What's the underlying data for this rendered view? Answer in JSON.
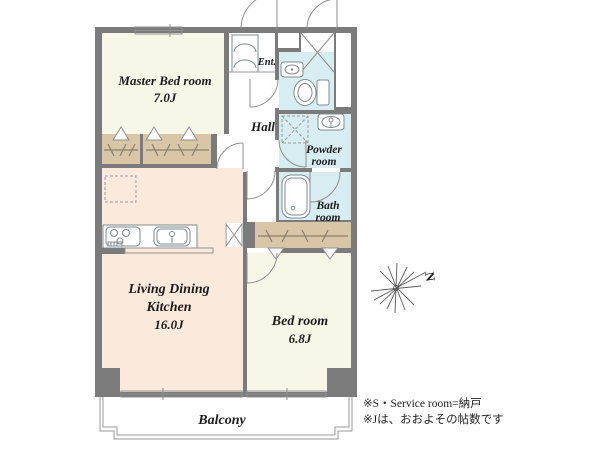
{
  "rooms": {
    "master_bedroom": {
      "name": "Master Bed room",
      "size": "7.0J"
    },
    "living_dining_kitchen": {
      "name_line1": "Living Dining",
      "name_line2": "Kitchen",
      "size": "16.0J"
    },
    "bedroom": {
      "name": "Bed room",
      "size": "6.8J"
    },
    "hall": {
      "name": "Hall"
    },
    "entrance": {
      "name": "Ent."
    },
    "powder_room": {
      "name_line1": "Powder",
      "name_line2": "room"
    },
    "bathroom": {
      "name_line1": "Bath",
      "name_line2": "room"
    },
    "balcony": {
      "name": "Balcony"
    }
  },
  "compass": {
    "north_label": "N"
  },
  "notes": {
    "line1": "※S・Service room=納戸",
    "line2": "※Jは、おおよその帖数です"
  },
  "colors": {
    "wall": "#7b7b7b",
    "room_ivory": "#f7f7e8",
    "room_peach": "#fbeadc",
    "room_blue": "#d8edf2",
    "closet_tan": "#d8c6a7",
    "floor_white": "#ffffff"
  }
}
